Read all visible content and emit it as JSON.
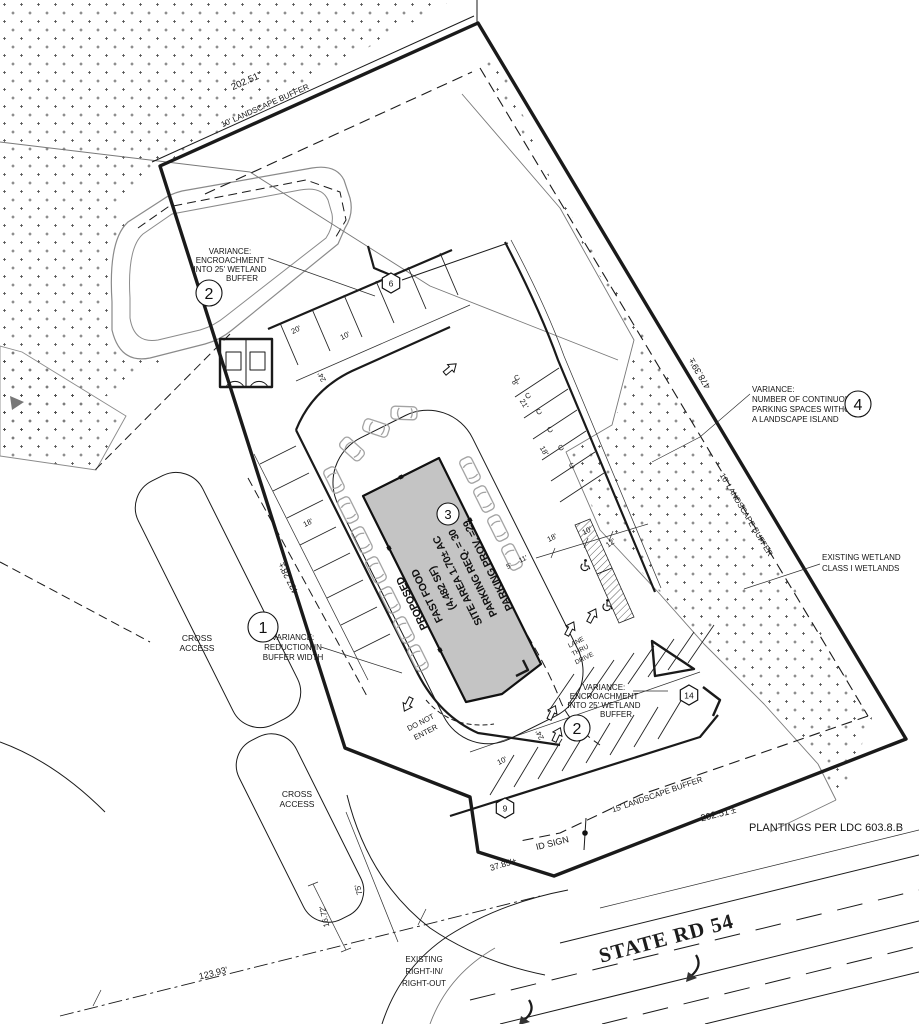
{
  "sheet": {
    "road_name": "STATE RD 54",
    "plantings_note": "PLANTINGS PER LDC 603.8.B",
    "id_sign": "ID SIGN"
  },
  "parcel": {
    "dim_top": "202.51'",
    "dim_left": "437.28'±",
    "dim_right": "478.39'±",
    "dim_bottom": "202.51'±",
    "dim_frontage": "37.85'±",
    "dim_entry_width": "16.72'",
    "dim_entry_depth": "75'",
    "dim_row_frontage": "123.93'"
  },
  "buffers": {
    "top": "10' LANDSCAPE BUFFER",
    "right": "10' LANDSCAPE BUFFER",
    "bottom": "15' LANDSCAPE BUFFER"
  },
  "building": {
    "keynote": "3",
    "line1": "PROPOSED",
    "line2": "FAST FOOD",
    "line3": "(4,482 SF)",
    "line4": "SITE AREA 1.70± AC",
    "line5": "PARKING REQ. = 30",
    "line6": "PARKING PROV. =29"
  },
  "variances": {
    "v1": {
      "num": "1",
      "l1": "VARIANCE:",
      "l2": "REDUCTION IN",
      "l3": "BUFFER WIDTH"
    },
    "v2": {
      "num": "2",
      "l1": "VARIANCE:",
      "l2": "ENCROACHMENT",
      "l3": "INTO 25' WETLAND",
      "l4": "BUFFER"
    },
    "v4": {
      "num": "4",
      "l1": "VARIANCE:",
      "l2": "NUMBER OF CONTINUOUS",
      "l3": "PARKING SPACES WITHOUT",
      "l4": "A LANDSCAPE ISLAND"
    }
  },
  "wetland": {
    "l1": "EXISTING WETLAND",
    "l2": "CLASS I WETLANDS"
  },
  "notes": {
    "cross1": "CROSS",
    "cross2": "ACCESS",
    "dne1": "DO NOT",
    "dne2": "ENTER",
    "lane1": "LANE",
    "lane2": "THRU",
    "lane3": "DRIVE",
    "exist1": "EXISTING",
    "exist2": "RIGHT-IN/",
    "exist3": "RIGHT-OUT",
    "compact": "C"
  },
  "keynotes": {
    "k6": "6",
    "k9": "9",
    "k14": "14"
  },
  "dims": {
    "d20": "20'",
    "d10": "10'",
    "d24": "24'",
    "d18": "18'",
    "d8": "8'",
    "d21": "21'",
    "d5": "5'",
    "d11": "11'",
    "d12": "12'"
  },
  "colors": {
    "ink": "#1a1a1a",
    "building_fill": "#c4c4c4",
    "car_gray": "#a3a3a3",
    "stipple": "#4a4a4a"
  }
}
